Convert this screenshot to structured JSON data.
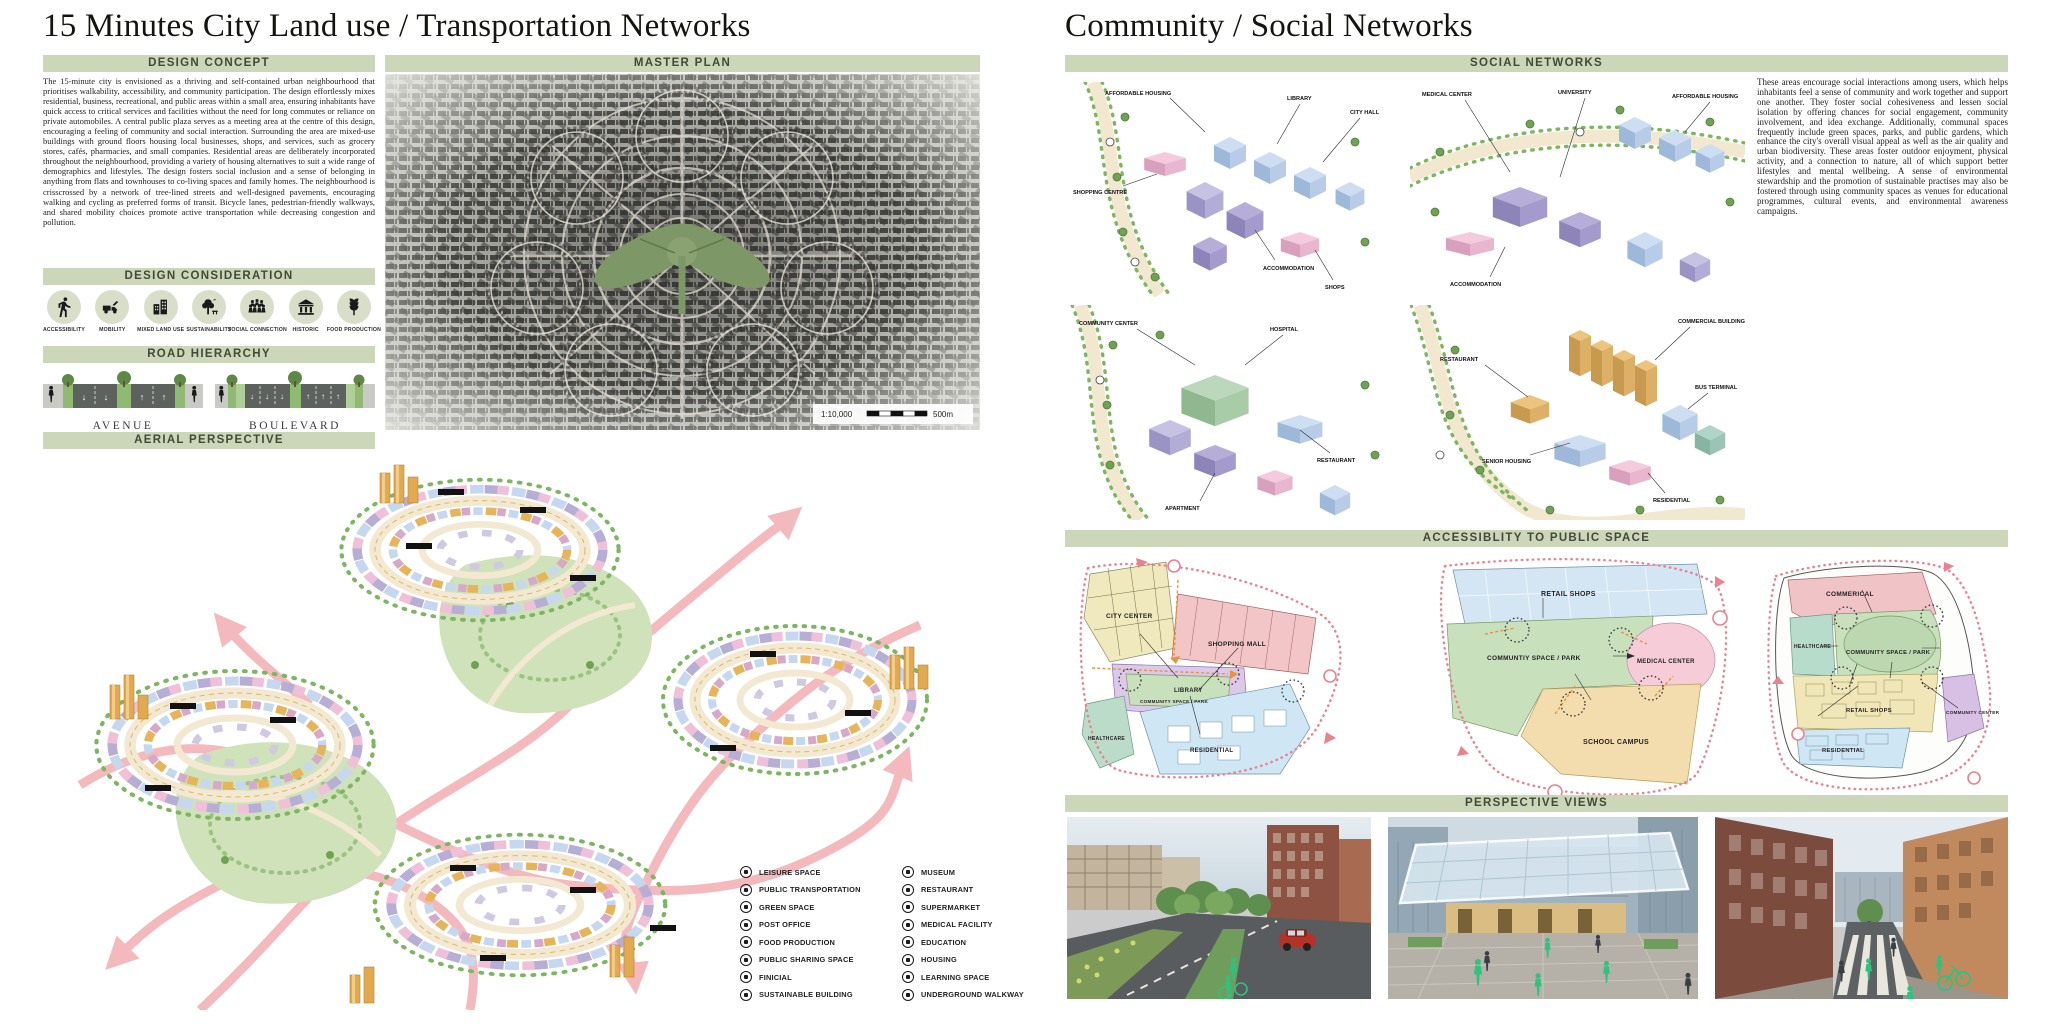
{
  "left_panel": {
    "title": "15 Minutes City Land use / Transportation Networks",
    "design_concept": {
      "header": "DESIGN CONCEPT",
      "body": "The 15-minute city is envisioned as a thriving and self-contained urban neighbourhood that prioritises walkability, accessibility, and community participation. The design effortlessly mixes residential, business, recreational, and public areas within a small area, ensuring inhabitants have quick access to critical services and facilities without the need for long commutes or reliance on private automobiles. A central public plaza serves as a meeting area at the centre of this design, encouraging a feeling of community and social interaction. Surrounding the area are mixed-use buildings with ground floors housing local businesses, shops, and services, such as grocery stores, cafés, pharmacies, and small companies. Residential areas are deliberately incorporated throughout the neighbourhood, providing a variety of housing alternatives to suit a wide range of demographics and lifestyles. The design fosters social inclusion and a sense of belonging in anything from flats and townhouses to co-living spaces and family homes. The neighbourhood is crisscrossed by a network of tree-lined streets and well-designed pavements, encouraging walking and cycling as preferred forms of transit. Bicycle lanes, pedestrian-friendly walkways, and shared mobility choices promote active transportation while decreasing congestion and pollution."
    },
    "master_plan": {
      "header": "MASTER PLAN",
      "scale_ratio": "1:10,000",
      "scale_distance": "500m"
    },
    "design_consideration": {
      "header": "DESIGN CONSIDERATION",
      "items": [
        {
          "label": "ACCESSIBILITY",
          "icon": "pedestrian-icon"
        },
        {
          "label": "MOBILITY",
          "icon": "vehicle-icon"
        },
        {
          "label": "MIXED LAND USE",
          "icon": "mixed-buildings-icon"
        },
        {
          "label": "SUSTAINABILITY",
          "icon": "tree-icon"
        },
        {
          "label": "SOCIAL CONNECTION",
          "icon": "people-group-icon"
        },
        {
          "label": "HISTORIC",
          "icon": "classical-building-icon"
        },
        {
          "label": "FOOD PRODUCTION",
          "icon": "wheat-icon"
        }
      ]
    },
    "road_hierarchy": {
      "header": "ROAD HIERARCHY",
      "roads": [
        {
          "label": "AVENUE"
        },
        {
          "label": "BOULEVARD"
        }
      ]
    },
    "aerial_perspective": {
      "header": "AERIAL PERSPECTIVE",
      "legend": {
        "col1": [
          {
            "label": "LEISURE SPACE",
            "icon": "leisure-space-icon"
          },
          {
            "label": "PUBLIC TRANSPORTATION",
            "icon": "public-transportation-icon"
          },
          {
            "label": "GREEN SPACE",
            "icon": "green-space-icon"
          },
          {
            "label": "POST OFFICE",
            "icon": "post-office-icon"
          },
          {
            "label": "FOOD PRODUCTION",
            "icon": "food-production-icon"
          },
          {
            "label": "PUBLIC SHARING SPACE",
            "icon": "public-sharing-space-icon"
          },
          {
            "label": "FINICIAL",
            "icon": "financial-icon"
          },
          {
            "label": "SUSTAINABLE BUILDING",
            "icon": "sustainable-building-icon"
          }
        ],
        "col2": [
          {
            "label": "MUSEUM",
            "icon": "museum-icon"
          },
          {
            "label": "RESTAURANT",
            "icon": "restaurant-icon"
          },
          {
            "label": "SUPERMARKET",
            "icon": "supermarket-icon"
          },
          {
            "label": "MEDICAL FACILITY",
            "icon": "medical-facility-icon"
          },
          {
            "label": "EDUCATION",
            "icon": "education-icon"
          },
          {
            "label": "HOUSING",
            "icon": "housing-icon"
          },
          {
            "label": "LEARNING SPACE",
            "icon": "learning-space-icon"
          },
          {
            "label": "UNDERGROUND WALKWAY",
            "icon": "underground-walkway-icon"
          }
        ]
      }
    }
  },
  "right_panel": {
    "title": "Community / Social Networks",
    "social_networks": {
      "header": "SOCIAL NETWORKS",
      "body": "These areas encourage social interactions among users, which helps inhabitants feel a sense of community and work together and support one another. They foster social cohesiveness and lessen social isolation by offering chances for social engagement, community involvement, and idea exchange. Additionally, communal spaces frequently include green spaces, parks, and public gardens, which enhance the city's overall visual appeal as well as the air quality and urban biodiversity. These areas foster outdoor enjoyment, physical activity, and a connection to nature, all of which support better lifestyles and mental wellbeing. A sense of environmental stewardship and the promotion of sustainable practises may also be fostered through using community spaces as venues for educational programmes, cultural events, and environmental awareness campaigns.",
      "labels": {
        "v1": [
          "AFFORDABLE HOUSING",
          "LIBRARY",
          "CITY HALL",
          "SHOPPING CENTRE",
          "ACCOMMODATION",
          "SHOPS"
        ],
        "v2": [
          "MEDICAL CENTER",
          "UNIVERSITY",
          "AFFORDABLE HOUSING",
          "ACCOMMODATION"
        ],
        "v3": [
          "COMMUNITY CENTER",
          "HOSPITAL",
          "RESTAURANT",
          "APARTMENT"
        ],
        "v4": [
          "COMMERCIAL BUILDING",
          "RESTAURANT",
          "BUS TERMINAL",
          "SENIOR HOUSING",
          "RESIDENTIAL"
        ]
      }
    },
    "accessibility": {
      "header": "ACCESSIBLITY TO PUBLIC SPACE",
      "diagram1": {
        "zones": [
          "CITY CENTER",
          "SHOPPING MALL",
          "LIBRARY",
          "COMMUNITY SPACE / PARK",
          "HEALTHCARE",
          "RESIDENTIAL"
        ]
      },
      "diagram2": {
        "zones": [
          "RETAIL SHOPS",
          "COMMUNTIY SPACE / PARK",
          "MEDICAL CENTER",
          "SCHOOL CAMPUS"
        ]
      },
      "diagram3": {
        "zones": [
          "COMMERICAL",
          "HEALTHCARE",
          "COMMUNITY SPACE / PARK",
          "RETAIL SHOPS",
          "COMMUNITY CENTER",
          "RESIDENTIAL"
        ]
      }
    },
    "perspective_views": {
      "header": "PERSPECTIVE VIEWS"
    }
  },
  "colors": {
    "header_bar": "#ccd6b8",
    "header_text": "#404b37",
    "arrow_pink": "#f4b6ba",
    "park_green": "#cfe2ba",
    "tree_green": "#7db560",
    "boundary_red": "#e8828f",
    "path_orange": "#e8923c"
  }
}
